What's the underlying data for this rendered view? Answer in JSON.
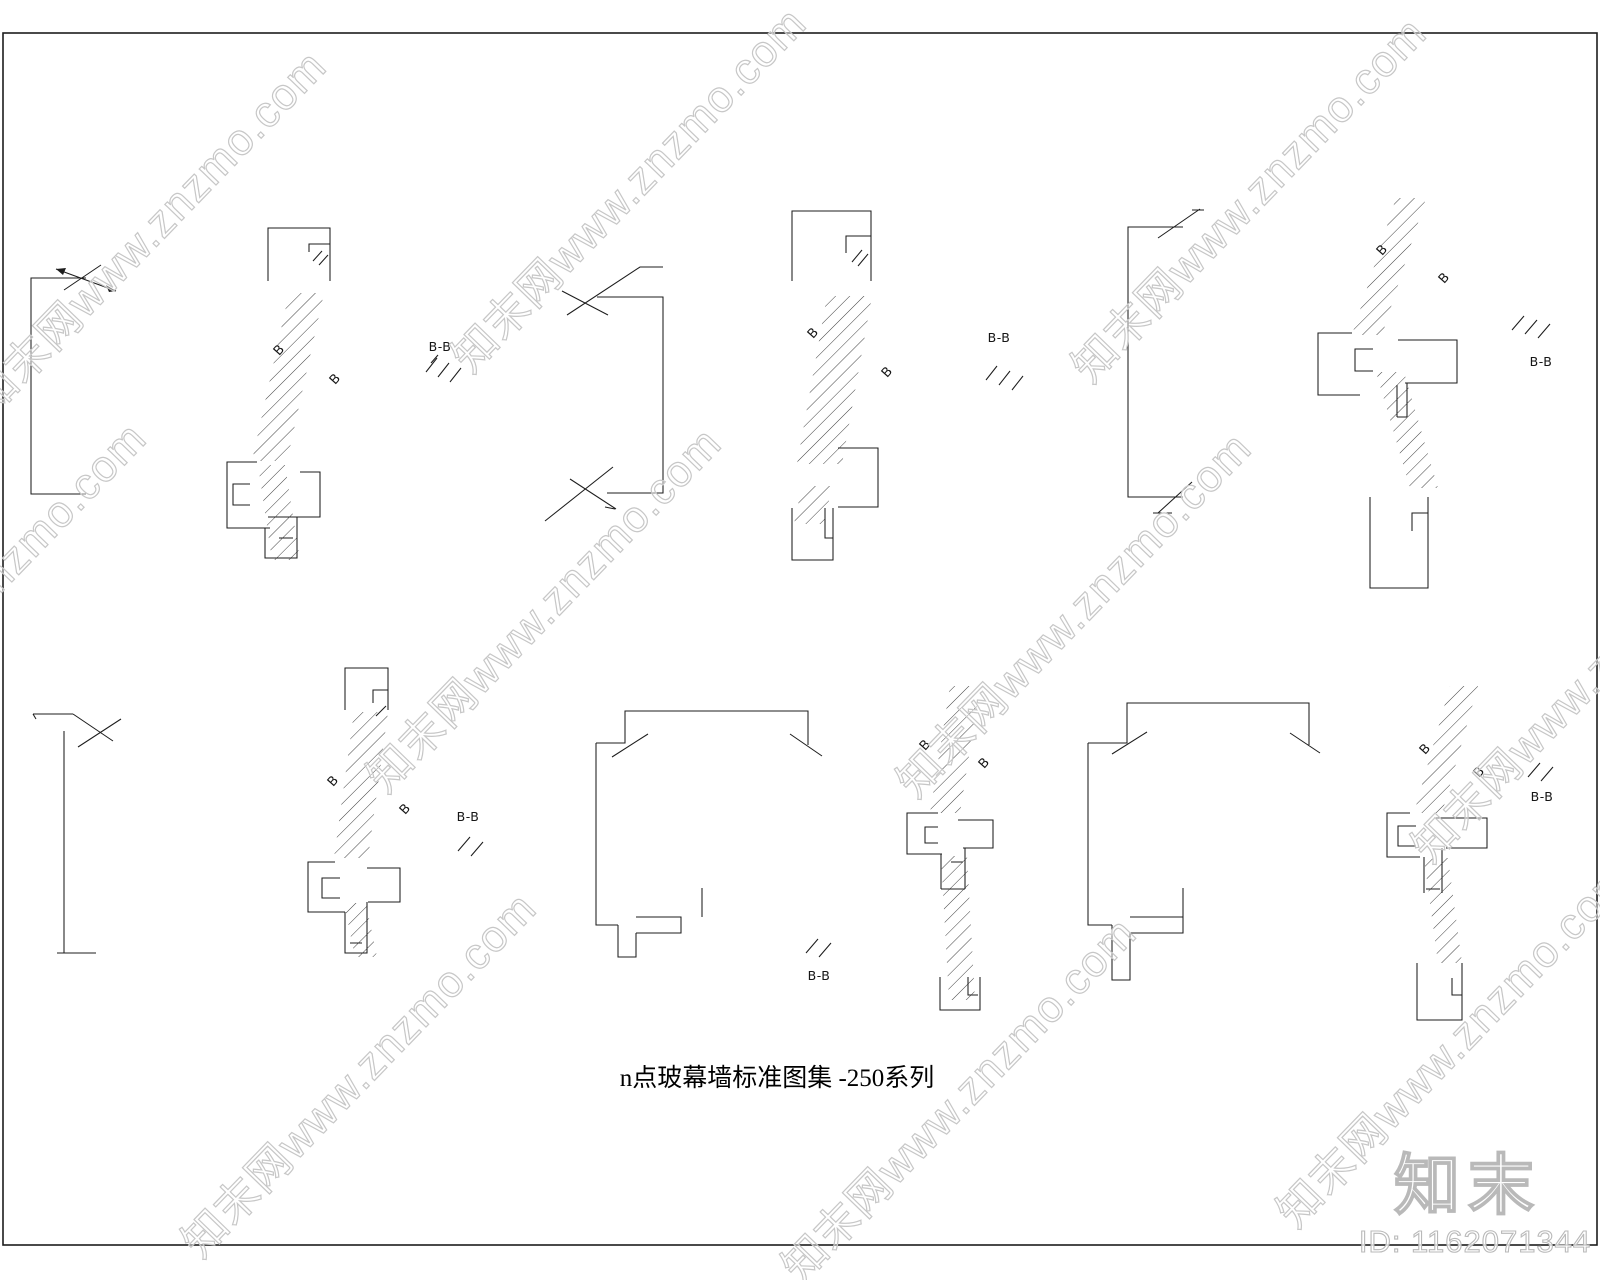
{
  "sheet": {
    "title": "n点玻幕墙标准图集 -250系列",
    "section_letter": "B",
    "section_label": "B-B"
  },
  "watermark": {
    "text": "知末网www.znzmo.com",
    "color": "#c7c7c7"
  },
  "branding": {
    "logo_text": "知末",
    "id_text": "ID: 1162071344"
  },
  "colors": {
    "line": "#1d1d1d",
    "background": "#ffffff",
    "watermark_stroke": "#c7c7c7",
    "logo_stroke": "#b9b9b9"
  }
}
